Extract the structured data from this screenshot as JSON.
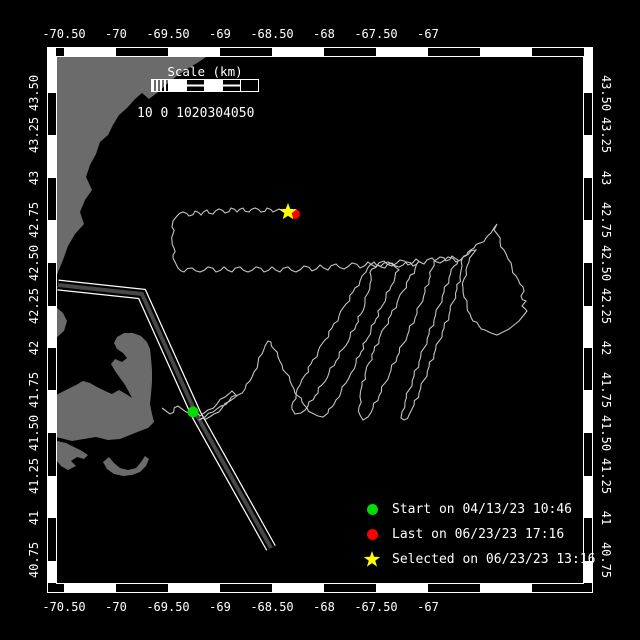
{
  "window": {
    "width": 640,
    "height": 640,
    "background": "#000000"
  },
  "map": {
    "frame": {
      "color": "#ffffff",
      "outer_rect": [
        47,
        47,
        546,
        546
      ],
      "inner_rect": [
        56,
        56,
        528,
        528
      ],
      "band_thickness": 8,
      "white_segments_x": [
        [
          64,
          116
        ],
        [
          168,
          220
        ],
        [
          272,
          324
        ],
        [
          376,
          428
        ],
        [
          480,
          532
        ]
      ],
      "white_segments_y": [
        [
          48,
          93
        ],
        [
          135,
          178
        ],
        [
          220,
          263
        ],
        [
          306,
          348
        ],
        [
          390,
          433
        ],
        [
          476,
          518
        ],
        [
          561,
          583
        ]
      ]
    },
    "axes": {
      "font_px": 12,
      "lon_labels": [
        "-70.50",
        "-70",
        "-69.50",
        "-69",
        "-68.50",
        "-68",
        "-67.50",
        "-67"
      ],
      "lon_x": [
        64,
        116,
        168,
        220,
        272,
        324,
        376,
        428
      ],
      "top_baseline_y": 38,
      "bottom_baseline_y": 611,
      "lat_labels": [
        "43.50",
        "43.25",
        "43",
        "42.75",
        "42.50",
        "42.25",
        "42",
        "41.75",
        "41.50",
        "41.25",
        "41",
        "40.75"
      ],
      "lat_y": [
        93,
        135,
        178,
        220,
        263,
        306,
        348,
        390,
        433,
        476,
        518,
        560
      ],
      "left_axis_x": 38,
      "right_axis_x": 602
    },
    "land": {
      "color": "#6b6b6b",
      "polygons": {
        "north-shore-coast": [
          48,
          57,
          206,
          57,
          197,
          63,
          187,
          69,
          177,
          76,
          167,
          84,
          157,
          93,
          149,
          99,
          142,
          93,
          135,
          99,
          127,
          108,
          119,
          115,
          113,
          125,
          108,
          135,
          100,
          142,
          96,
          154,
          90,
          165,
          86,
          177,
          92,
          190,
          85,
          200,
          80,
          212,
          84,
          224,
          75,
          234,
          68,
          246,
          63,
          260,
          58,
          272,
          54,
          284,
          50,
          294,
          48,
          300
        ],
        "plymouth-coast": [
          48,
          304,
          56,
          307,
          63,
          313,
          67,
          321,
          64,
          331,
          56,
          338,
          49,
          342,
          48,
          342
        ],
        "cape-cod": [
          48,
          436,
          60,
          438,
          72,
          441,
          84,
          439,
          96,
          437,
          108,
          440,
          120,
          439,
          130,
          435,
          140,
          431,
          148,
          428,
          154,
          422,
          152,
          414,
          150,
          404,
          151,
          394,
          152,
          382,
          152,
          370,
          151,
          358,
          150,
          349,
          147,
          342,
          141,
          336,
          133,
          333,
          124,
          333,
          117,
          337,
          114,
          343,
          117,
          349,
          123,
          353,
          127,
          358,
          122,
          362,
          115,
          359,
          111,
          364,
          115,
          371,
          120,
          378,
          125,
          385,
          129,
          392,
          132,
          398,
          126,
          394,
          119,
          390,
          112,
          394,
          105,
          391,
          97,
          387,
          90,
          383,
          83,
          381,
          76,
          385,
          68,
          389,
          60,
          393,
          52,
          397,
          48,
          399
        ],
        "marthas-vineyard": [
          57,
          441,
          66,
          443,
          74,
          447,
          82,
          451,
          88,
          455,
          84,
          459,
          77,
          457,
          71,
          461,
          76,
          466,
          68,
          470,
          61,
          466,
          57,
          461
        ],
        "nantucket": [
          103,
          462,
          109,
          457,
          114,
          463,
          120,
          468,
          128,
          470,
          136,
          468,
          141,
          462,
          145,
          456,
          149,
          459,
          146,
          466,
          140,
          472,
          132,
          475,
          123,
          476,
          114,
          474,
          107,
          469
        ],
        "elizabeth-islands": [
          57,
          444,
          63,
          447,
          69,
          451,
          64,
          454,
          58,
          451
        ]
      }
    },
    "shipping_lane": {
      "casing_color": "#ffffff",
      "gap_color": "#000000",
      "core_color": "#474747",
      "path": [
        58,
        285,
        142,
        294,
        196,
        414,
        271,
        548
      ]
    },
    "track": {
      "color": "#c3c3c3",
      "points": [
        162,
        408,
        170,
        414,
        178,
        406,
        186,
        412,
        193,
        411,
        200,
        416,
        208,
        410,
        217,
        404,
        225,
        397,
        232,
        391,
        236,
        395,
        229,
        401,
        221,
        406,
        213,
        412,
        205,
        417,
        199,
        420,
        206,
        419,
        214,
        414,
        222,
        408,
        230,
        401,
        238,
        395,
        245,
        389,
        250,
        381,
        254,
        372,
        258,
        363,
        262,
        354,
        265,
        346,
        268,
        341,
        271,
        342,
        274,
        349,
        278,
        357,
        282,
        365,
        286,
        373,
        290,
        381,
        294,
        389,
        298,
        396,
        302,
        402,
        307,
        408,
        312,
        413,
        318,
        416,
        323,
        417,
        328,
        413,
        332,
        407,
        336,
        400,
        341,
        392,
        346,
        383,
        351,
        373,
        356,
        363,
        361,
        352,
        366,
        341,
        371,
        330,
        376,
        319,
        381,
        308,
        386,
        297,
        391,
        286,
        395,
        277,
        399,
        270,
        394,
        266,
        388,
        262,
        381,
        266,
        374,
        262,
        370,
        265,
        366,
        272,
        360,
        281,
        353,
        292,
        346,
        304,
        339,
        316,
        332,
        328,
        325,
        340,
        318,
        352,
        311,
        364,
        305,
        375,
        300,
        385,
        296,
        394,
        293,
        402,
        292,
        409,
        295,
        414,
        301,
        413,
        308,
        406,
        315,
        396,
        322,
        385,
        329,
        373,
        336,
        361,
        343,
        349,
        350,
        337,
        356,
        325,
        361,
        314,
        365,
        303,
        368,
        293,
        370,
        284,
        371,
        276,
        372,
        269,
        378,
        265,
        385,
        268,
        392,
        263,
        399,
        267,
        406,
        262,
        413,
        266,
        419,
        261,
        415,
        269,
        409,
        279,
        403,
        291,
        397,
        303,
        391,
        315,
        385,
        327,
        379,
        339,
        374,
        351,
        369,
        363,
        365,
        375,
        362,
        386,
        360,
        397,
        359,
        407,
        360,
        415,
        363,
        420,
        368,
        417,
        373,
        408,
        379,
        396,
        385,
        383,
        391,
        370,
        397,
        357,
        403,
        344,
        409,
        331,
        415,
        318,
        420,
        305,
        425,
        292,
        429,
        280,
        432,
        269,
        434,
        261,
        440,
        257,
        446,
        261,
        452,
        256,
        458,
        260,
        454,
        266,
        449,
        278,
        444,
        292,
        439,
        306,
        434,
        320,
        429,
        334,
        424,
        348,
        419,
        362,
        414,
        376,
        409,
        390,
        405,
        402,
        402,
        412,
        401,
        418,
        404,
        420,
        409,
        415,
        414,
        405,
        419,
        393,
        424,
        380,
        429,
        367,
        434,
        354,
        439,
        341,
        444,
        328,
        449,
        315,
        453,
        302,
        457,
        289,
        460,
        277,
        462,
        266,
        463,
        257,
        468,
        252,
        474,
        248,
        480,
        243,
        486,
        238,
        491,
        233,
        494,
        228,
        497,
        224,
        494,
        230,
        498,
        235,
        500,
        242,
        504,
        250,
        508,
        259,
        512,
        268,
        516,
        276,
        520,
        284,
        524,
        291,
        521,
        296,
        526,
        301,
        522,
        306,
        527,
        311,
        523,
        316,
        519,
        321,
        514,
        325,
        509,
        329,
        503,
        332,
        497,
        335,
        491,
        333,
        485,
        330,
        479,
        326,
        473,
        321,
        470,
        314,
        467,
        306,
        464,
        297,
        463,
        288,
        464,
        279,
        466,
        270,
        469,
        262,
        472,
        255,
        476,
        250,
        464,
        256,
        456,
        262,
        448,
        257,
        440,
        263,
        432,
        258,
        424,
        264,
        416,
        259,
        408,
        265,
        400,
        260,
        392,
        266,
        384,
        261,
        376,
        267,
        368,
        262,
        360,
        268,
        352,
        263,
        344,
        269,
        336,
        264,
        328,
        270,
        320,
        265,
        312,
        271,
        304,
        266,
        296,
        272,
        288,
        267,
        280,
        272,
        272,
        267,
        264,
        272,
        256,
        267,
        248,
        272,
        240,
        267,
        232,
        272,
        224,
        267,
        216,
        272,
        208,
        267,
        200,
        272,
        192,
        268,
        184,
        272,
        178,
        268,
        175,
        262,
        173,
        255,
        174,
        248,
        172,
        241,
        173,
        234,
        172,
        227,
        173,
        221,
        177,
        216,
        183,
        212,
        189,
        216,
        195,
        211,
        201,
        215,
        207,
        210,
        213,
        214,
        219,
        209,
        225,
        213,
        231,
        208,
        237,
        212,
        243,
        208,
        249,
        212,
        255,
        208,
        261,
        212,
        267,
        208,
        273,
        212,
        279,
        209,
        284,
        212,
        288,
        212
      ]
    },
    "markers": {
      "start": {
        "x": 193,
        "y": 412,
        "r": 5.5,
        "color": "#00dd00",
        "shape": "circle"
      },
      "last": {
        "x": 295,
        "y": 214,
        "r": 5.0,
        "color": "#ff0000",
        "shape": "circle"
      },
      "selected": {
        "x": 288,
        "y": 212,
        "R": 9,
        "r2": 3.8,
        "color": "#ffff00",
        "shape": "star"
      }
    },
    "scale_bar": {
      "title": "Scale (km)",
      "title_x": 205,
      "title_y": 76,
      "labels_text": "10 0 1020304050",
      "labels_x": 137,
      "labels_y": 117,
      "x": 152,
      "y": 80,
      "height": 11,
      "segments": [
        {
          "type": "hatch",
          "x0": 152,
          "x1": 168
        },
        {
          "type": "fill",
          "x0": 168,
          "x1": 186
        },
        {
          "type": "line",
          "x0": 186,
          "x1": 204
        },
        {
          "type": "fill",
          "x0": 204,
          "x1": 222
        },
        {
          "type": "line",
          "x0": 222,
          "x1": 240
        },
        {
          "type": "empty",
          "x0": 240,
          "x1": 258
        }
      ]
    },
    "legend": {
      "text_color": "#ffffff",
      "items": [
        {
          "shape": "circle",
          "color": "#00dd00",
          "label": "Start on 04/13/23 10:46"
        },
        {
          "shape": "circle",
          "color": "#ff0000",
          "label": "Last on 06/23/23 17:16"
        },
        {
          "shape": "star",
          "color": "#ffff00",
          "label": "Selected on 06/23/23 13:16"
        }
      ]
    }
  }
}
